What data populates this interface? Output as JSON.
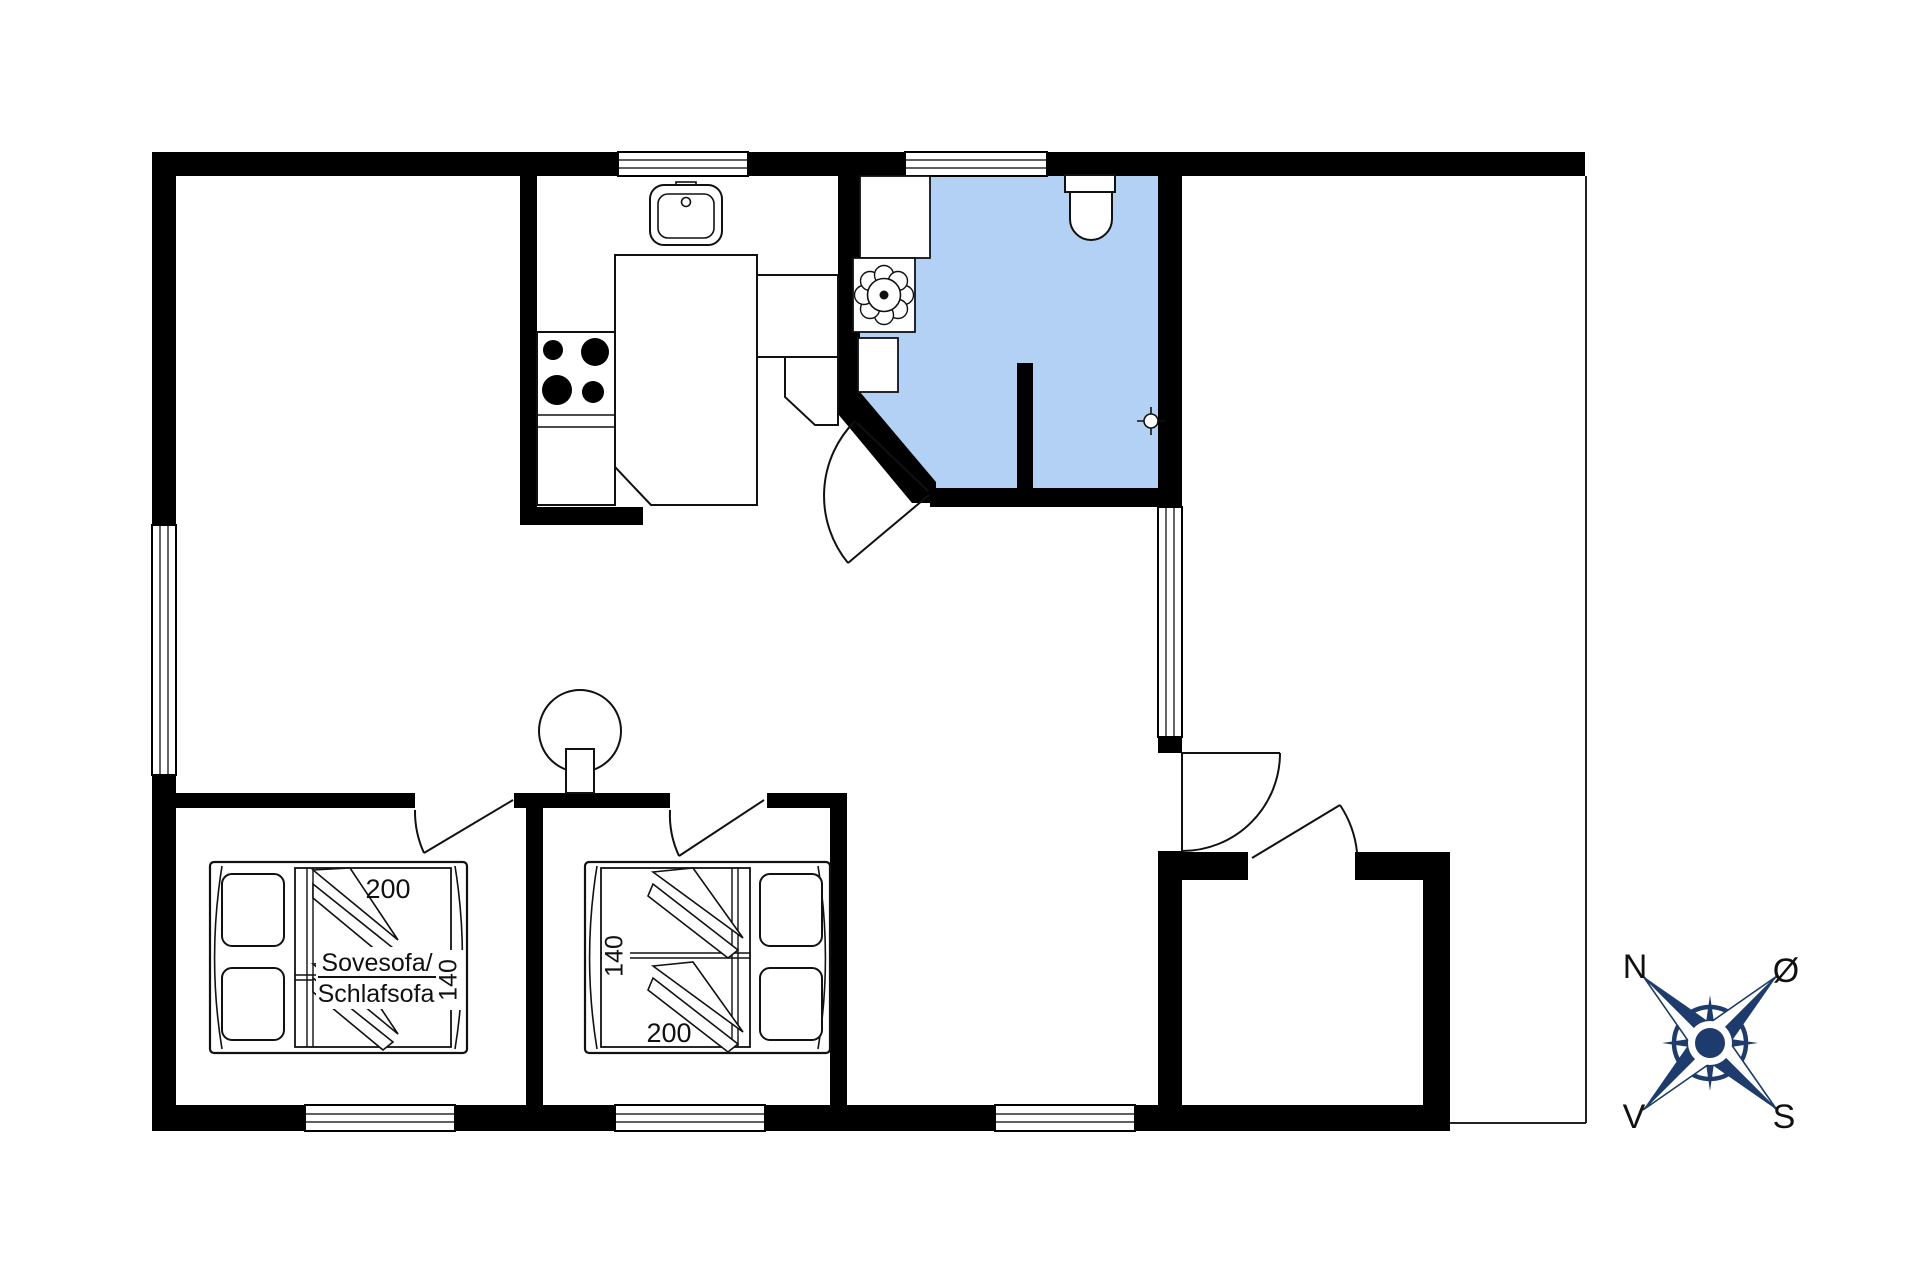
{
  "plan": {
    "bedroom1": {
      "bed_length": "200",
      "bed_width": "140",
      "sofa_line1": "Sovesofa/",
      "sofa_line2": "Schlafsofa"
    },
    "bedroom2": {
      "bed_width": "140",
      "bed_length": "200"
    },
    "compass": {
      "north": "N",
      "east": "Ø",
      "west": "V",
      "south": "S"
    }
  },
  "colors": {
    "wall": "#000000",
    "line": "#111111",
    "bathroom_floor": "#b3d1f4",
    "compass_navy": "#1d3b6d"
  }
}
